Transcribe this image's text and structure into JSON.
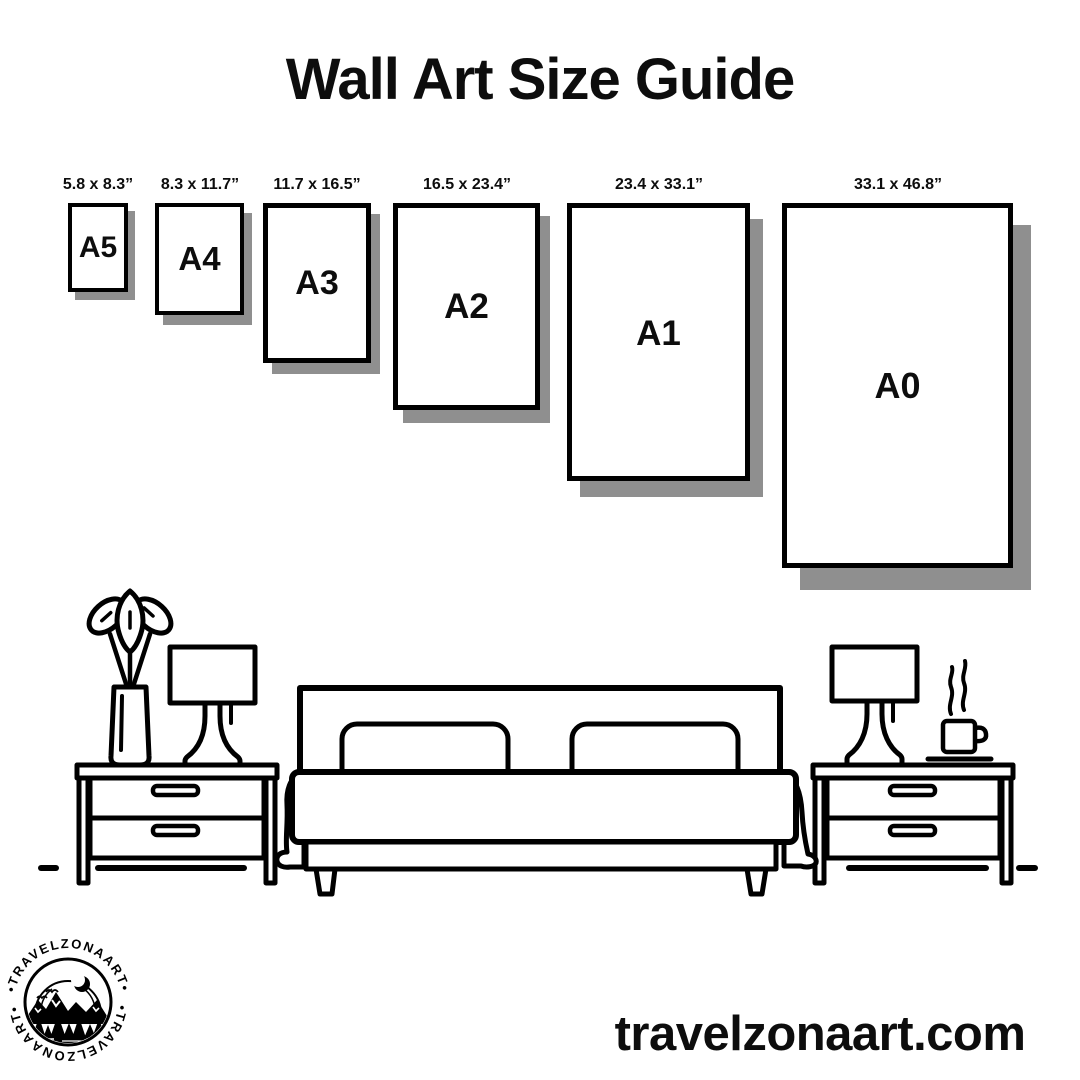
{
  "title": "Wall Art Size Guide",
  "frames": [
    {
      "name": "A5",
      "size_label": "5.8 x 8.3”"
    },
    {
      "name": "A4",
      "size_label": "8.3 x 11.7”"
    },
    {
      "name": "A3",
      "size_label": "11.7 x 16.5”"
    },
    {
      "name": "A2",
      "size_label": "16.5 x 23.4”"
    },
    {
      "name": "A1",
      "size_label": "23.4 x 33.1”"
    },
    {
      "name": "A0",
      "size_label": "33.1 x 46.8”"
    }
  ],
  "logo": {
    "arc_text_top": "•TRAVELZONAART•",
    "arc_text_bottom": "•TRAVELZONAART•"
  },
  "footer": {
    "website": "travelzonaart.com"
  },
  "colors": {
    "ink": "#000000",
    "frame_shadow": "#8f8f8f",
    "background": "#ffffff"
  },
  "scene": {
    "items": [
      "vase-plant-icon",
      "table-lamp-icon",
      "nightstand-icon",
      "double-bed-icon",
      "nightstand-icon",
      "table-lamp-icon",
      "coffee-cup-icon"
    ]
  }
}
